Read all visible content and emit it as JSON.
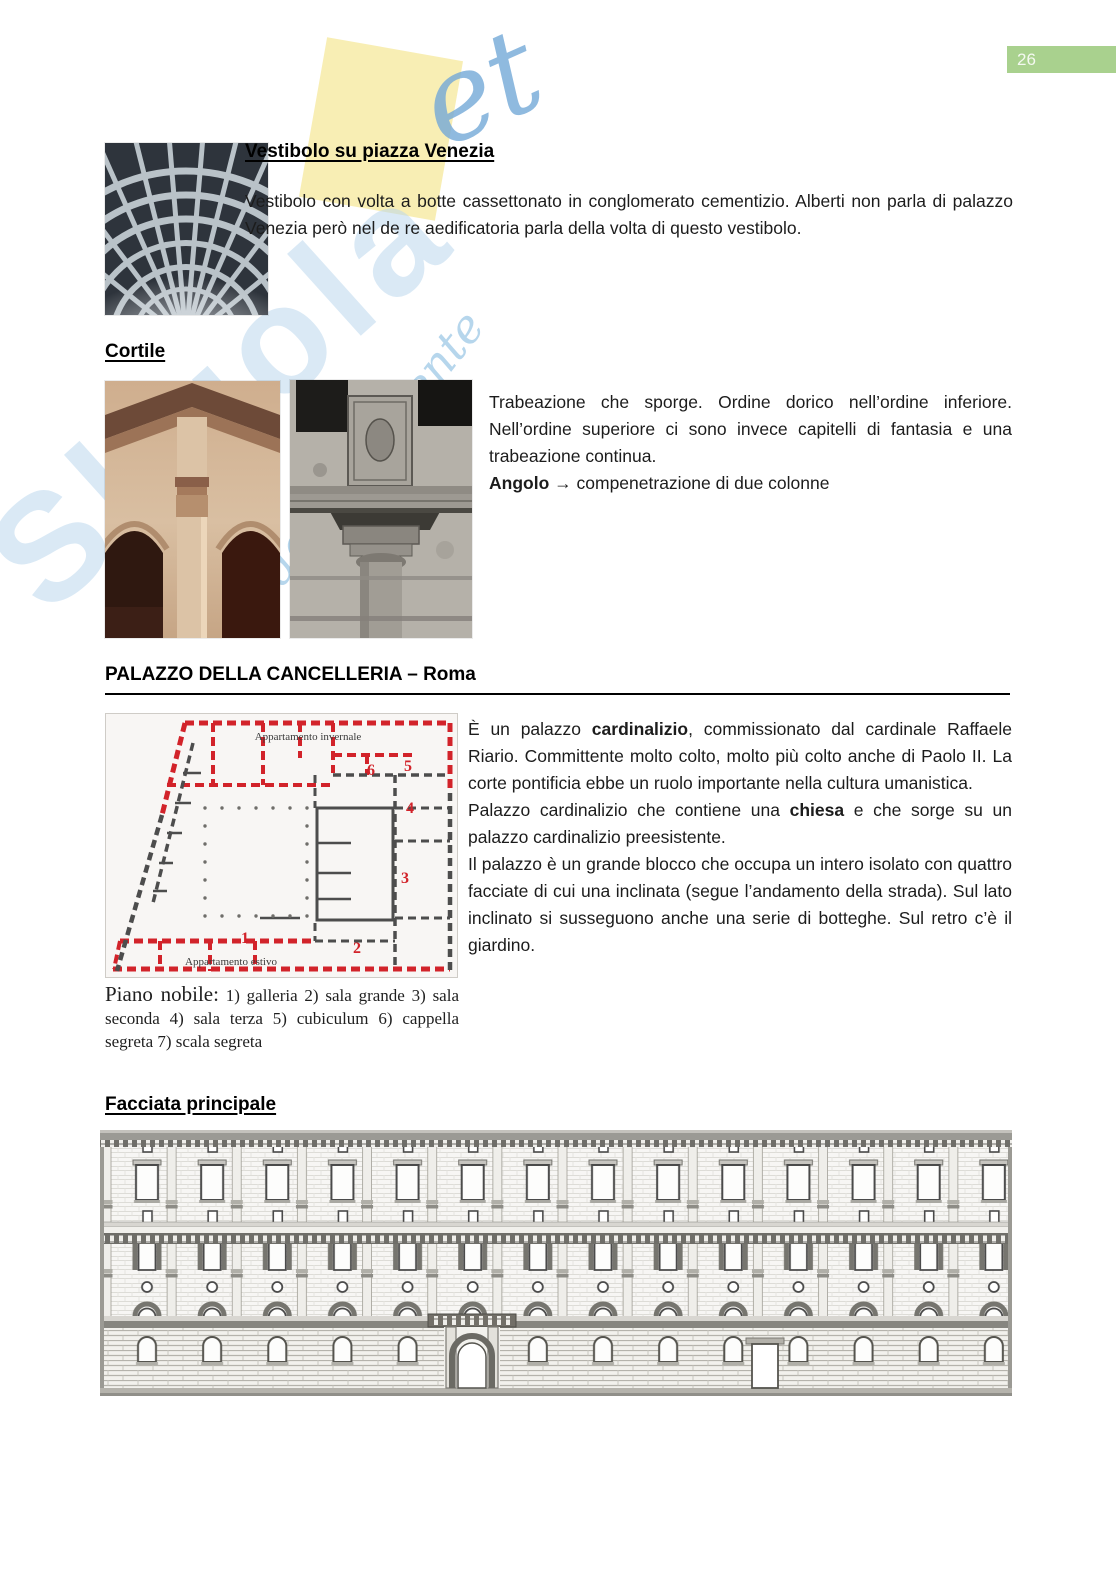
{
  "page": {
    "number": "26"
  },
  "watermark": {
    "brand": "Skuola",
    "script_et": "et",
    "tagline": "dello studente",
    "yellow_color": "#f8edb0",
    "blue_color": "#bcd8ee"
  },
  "vestibolo": {
    "heading": "Vestibolo su piazza Venezia",
    "body": "Vestibolo con volta a botte cassettonato in conglomerato cementizio. Alberti non parla di palazzo Venezia però nel de re aedificatoria parla della volta di questo vestibolo."
  },
  "cortile": {
    "heading": "Cortile",
    "body": "Trabeazione che sporge. Ordine dorico nell’ordine inferiore. Nell’ordine superiore ci sono invece capitelli di fantasia e una trabeazione continua.",
    "angolo_term": "Angolo",
    "angolo_arrow": "→",
    "angolo_rest": " compenetrazione di due colonne"
  },
  "cancelleria": {
    "heading": "PALAZZO DELLA CANCELLERIA – Roma",
    "p1_pre": "È un palazzo ",
    "p1_bold": "cardinalizio",
    "p1_post": ", commissionato dal cardinale Raffaele Riario. Committente molto colto, molto più colto anche di Paolo II. La corte pontificia ebbe un ruolo importante nella cultura umanistica.",
    "p2_pre": "Palazzo cardinalizio che contiene una ",
    "p2_bold": "chiesa",
    "p2_post": " e che sorge su un palazzo cardinalizio preesistente.",
    "p3": "Il palazzo è un grande blocco che occupa un intero isolato con quattro facciate di cui una inclinata (segue l’andamento della strada). Sul lato inclinato si susseguono anche una serie di botteghe. Sul retro c’è il giardino.",
    "plan": {
      "label_top": "Appartamento invernale",
      "label_bottom": "Appartamento estivo",
      "numbers": [
        "1",
        "2",
        "3",
        "4",
        "5",
        "6"
      ],
      "red_color": "#d2232a"
    },
    "caption_lead": "Piano nobile:",
    "caption_rest": " 1) galleria 2) sala grande 3) sala seconda 4) sala terza 5) cubiculum 6) cappella segreta 7) scala segreta"
  },
  "facciata": {
    "heading": "Facciata principale"
  }
}
